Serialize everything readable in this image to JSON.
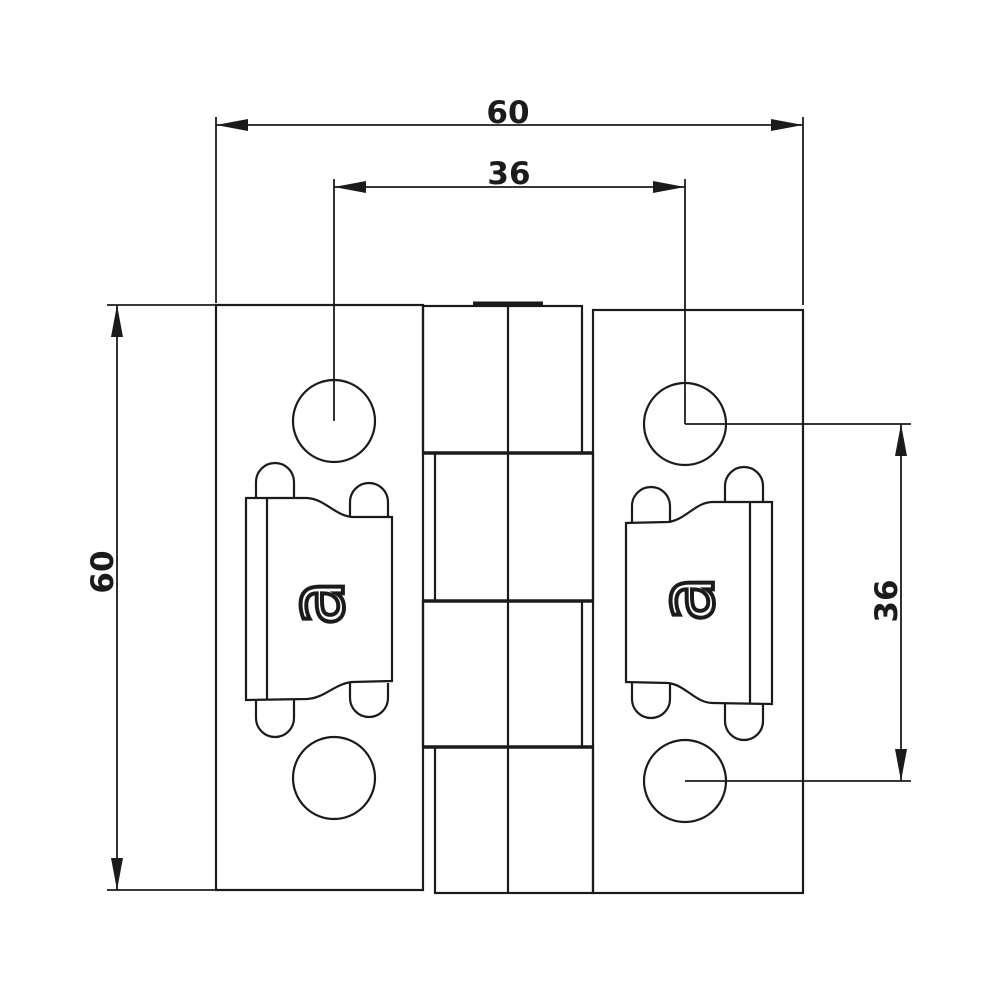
{
  "page": {
    "background": "#ffffff"
  },
  "drawing": {
    "subject": "hinge-top-view-technical-drawing",
    "line_color": "#1b1b1b",
    "labels": {
      "overall_width": "60",
      "hole_spacing_horizontal": "36",
      "overall_height": "60",
      "hole_spacing_vertical": "36"
    },
    "insert_logo_letter": "a"
  }
}
